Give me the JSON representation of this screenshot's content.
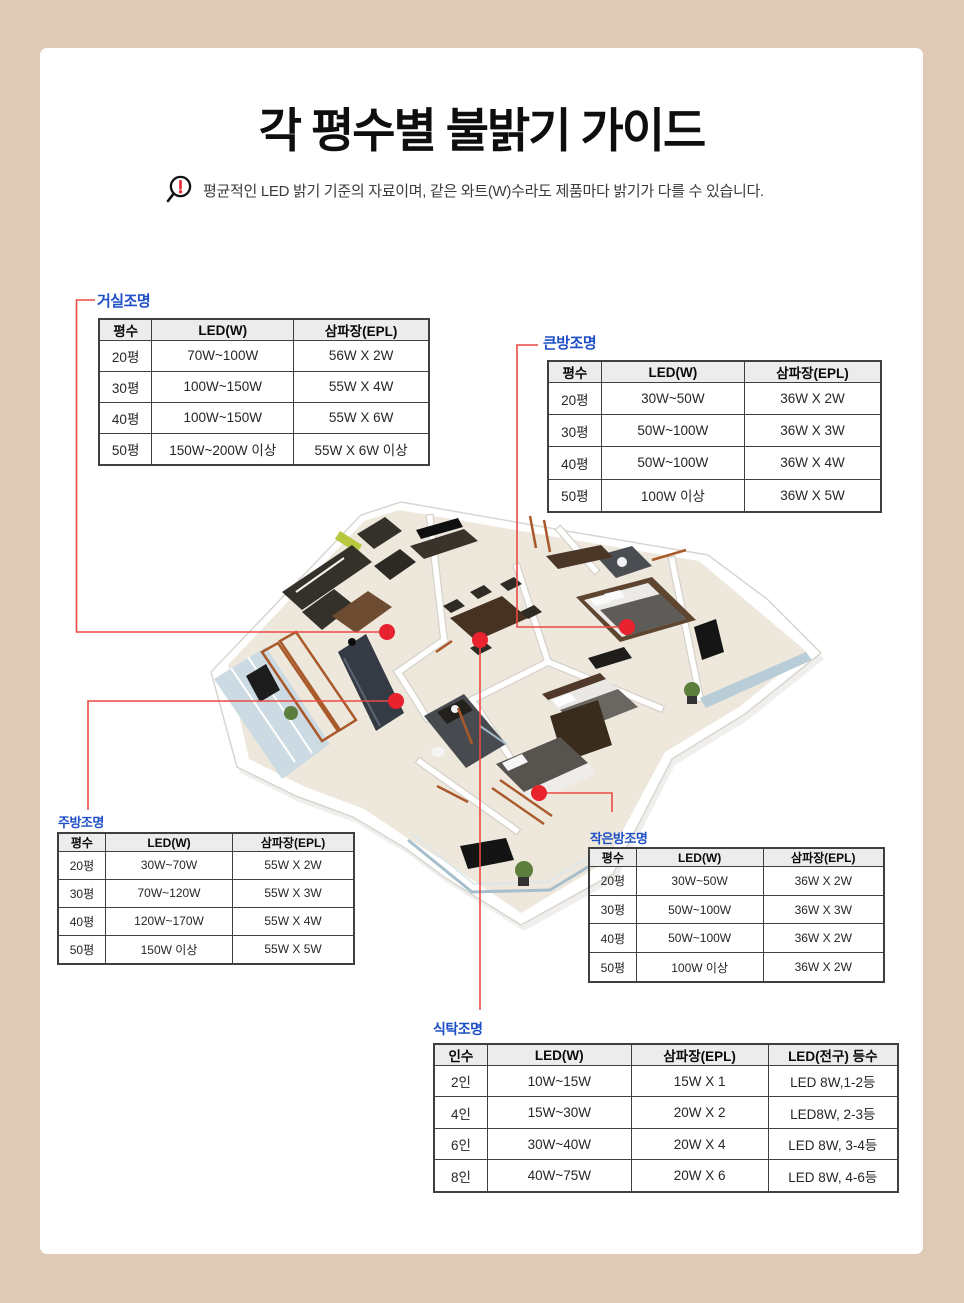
{
  "page": {
    "title": "각 평수별 불밝기 가이드",
    "note": "평균적인 LED 밝기 기준의 자료이며, 같은 와트(W)수라도 제품마다 밝기가 다를 수 있습니다.",
    "note_icon": "magnifier-exclamation-icon"
  },
  "colors": {
    "frame_bg": "#decab6",
    "label_blue": "#1e4fc6",
    "marker_red": "#e8232d",
    "line_red": "#ea4a44",
    "table_header_bg": "#ececec",
    "table_border": "#3f3f3f"
  },
  "tables": [
    {
      "id": "living-room",
      "label": "거실조명",
      "headers": [
        "평수",
        "LED(W)",
        "삼파장(EPL)"
      ],
      "rows": [
        [
          "20평",
          "70W~100W",
          "56W X 2W"
        ],
        [
          "30평",
          "100W~150W",
          "55W X 4W"
        ],
        [
          "40평",
          "100W~150W",
          "55W X 6W"
        ],
        [
          "50평",
          "150W~200W 이상",
          "55W X 6W 이상"
        ]
      ]
    },
    {
      "id": "master-bedroom",
      "label": "큰방조명",
      "headers": [
        "평수",
        "LED(W)",
        "삼파장(EPL)"
      ],
      "rows": [
        [
          "20평",
          "30W~50W",
          "36W X 2W"
        ],
        [
          "30평",
          "50W~100W",
          "36W X 3W"
        ],
        [
          "40평",
          "50W~100W",
          "36W X 4W"
        ],
        [
          "50평",
          "100W 이상",
          "36W X 5W"
        ]
      ]
    },
    {
      "id": "kitchen",
      "label": "주방조명",
      "headers": [
        "평수",
        "LED(W)",
        "삼파장(EPL)"
      ],
      "rows": [
        [
          "20평",
          "30W~70W",
          "55W X 2W"
        ],
        [
          "30평",
          "70W~120W",
          "55W X 3W"
        ],
        [
          "40평",
          "120W~170W",
          "55W X 4W"
        ],
        [
          "50평",
          "150W 이상",
          "55W X 5W"
        ]
      ]
    },
    {
      "id": "small-bedroom",
      "label": "작은방조명",
      "headers": [
        "평수",
        "LED(W)",
        "삼파장(EPL)"
      ],
      "rows": [
        [
          "20평",
          "30W~50W",
          "36W X 2W"
        ],
        [
          "30평",
          "50W~100W",
          "36W X 3W"
        ],
        [
          "40평",
          "50W~100W",
          "36W X 2W"
        ],
        [
          "50평",
          "100W 이상",
          "36W X 2W"
        ]
      ]
    },
    {
      "id": "dining-table",
      "label": "식탁조명",
      "headers": [
        "인수",
        "LED(W)",
        "삼파장(EPL)",
        "LED(전구) 등수"
      ],
      "rows": [
        [
          "2인",
          "10W~15W",
          "15W X 1",
          "LED 8W,1-2등"
        ],
        [
          "4인",
          "15W~30W",
          "20W X 2",
          "LED8W, 2-3등"
        ],
        [
          "6인",
          "30W~40W",
          "20W X 4",
          "LED 8W, 3-4등"
        ],
        [
          "8인",
          "40W~75W",
          "20W X 6",
          "LED 8W, 4-6등"
        ]
      ]
    }
  ],
  "floorplan": {
    "description": "3D isometric apartment floor plan",
    "markers": [
      "living-room",
      "master-bedroom",
      "kitchen",
      "small-bedroom",
      "dining-table"
    ]
  }
}
